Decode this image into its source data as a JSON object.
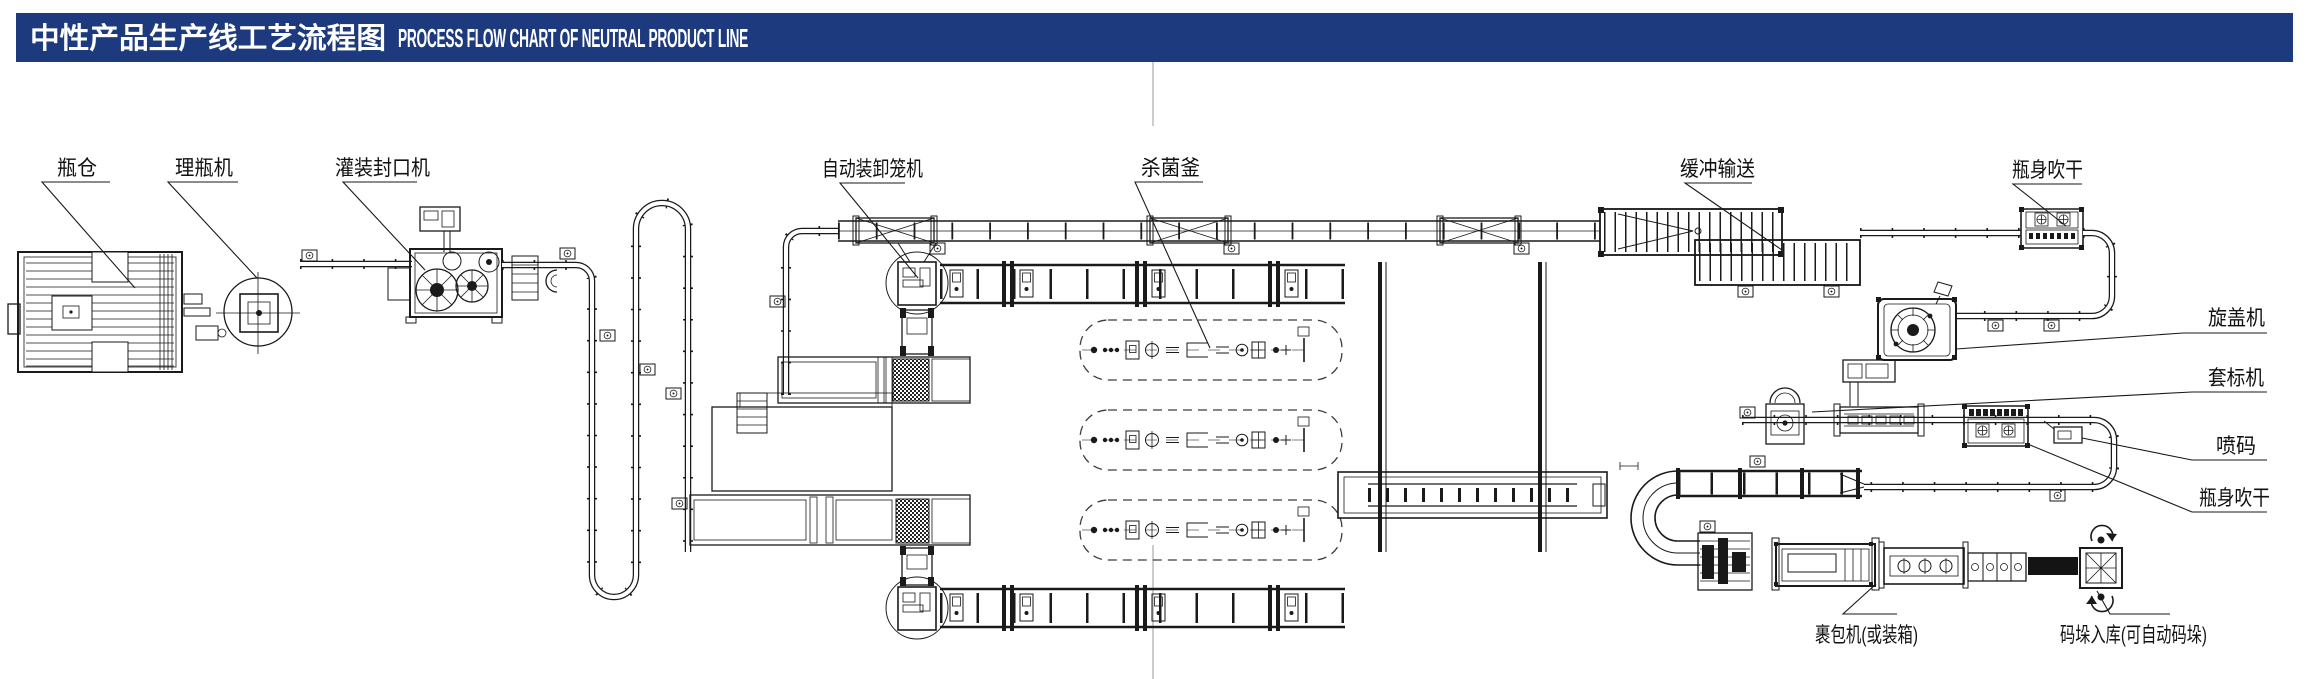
{
  "header": {
    "title_zh": "中性产品生产线工艺流程图",
    "title_en": "PROCESS FLOW CHART OF NEUTRAL PRODUCT LINE",
    "bg_color": "#1e3a7e",
    "text_color": "#ffffff"
  },
  "diagram": {
    "line_color": "#1a1a1a",
    "fold_line_color": "#bcbcbc",
    "labels": {
      "bottle_silo": "瓶仓",
      "bottle_unscrambler": "理瓶机",
      "filling_sealing_machine": "灌装封口机",
      "auto_cage_loader": "自动装卸笼机",
      "sterilization_kettle": "杀菌釜",
      "buffer_conveyor": "缓冲输送",
      "bottle_drying_top": "瓶身吹干",
      "capping_machine": "旋盖机",
      "sleeve_labeling_machine": "套标机",
      "inkjet_coding": "喷码",
      "bottle_drying_right": "瓶身吹干",
      "wrapping_machine": "裹包机(或装箱)",
      "palletizing_warehouse": "码垛入库(可自动码垛)"
    }
  }
}
